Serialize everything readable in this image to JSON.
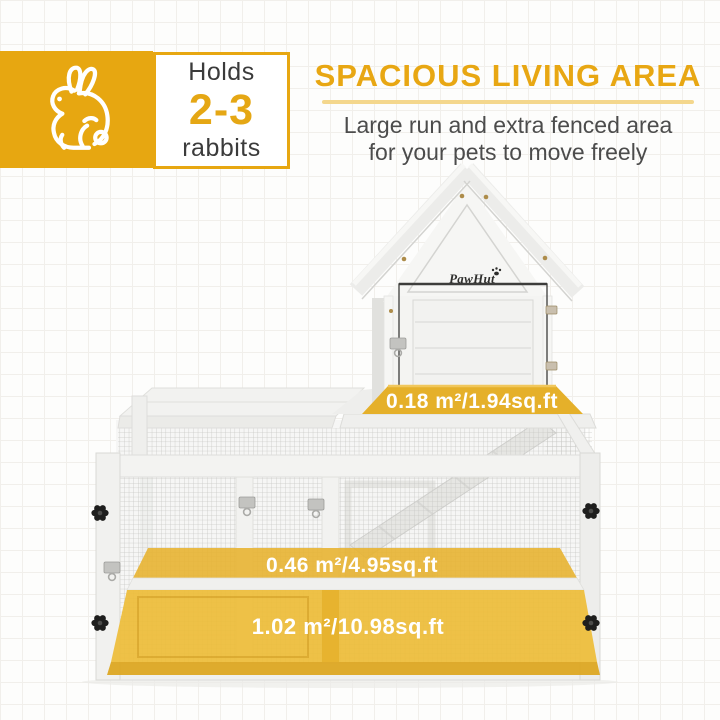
{
  "badge": {
    "holds_label": "Holds",
    "capacity": "2-3",
    "unit_label": "rabbits"
  },
  "header": {
    "title": "SPACIOUS LIVING AREA",
    "subtitle_line1": "Large run and extra fenced area",
    "subtitle_line2": "for your pets to move freely"
  },
  "hutch": {
    "brand": "PawHut",
    "areas": [
      {
        "id": "house-platform",
        "label": "0.18 m²/1.94sq.ft"
      },
      {
        "id": "raised-run",
        "label": "0.46 m²/4.95sq.ft"
      },
      {
        "id": "ground-run",
        "label": "1.02 m²/10.98sq.ft"
      }
    ]
  },
  "colors": {
    "accent_yellow": "#E7A711",
    "heading_yellow": "#E8A713",
    "underline_yellow": "#F4D78D",
    "overlay_yellow": "#EDBB34",
    "platform_band_yellow": "#E5B02A",
    "dark_text": "#3B3B3B",
    "body_text": "#4C4C4C",
    "area_label_text": "#FFFFFF",
    "hutch_white": "#F3F3F1",
    "mesh_gray": "#C7C7C4",
    "knob_black": "#1E1E1D"
  }
}
